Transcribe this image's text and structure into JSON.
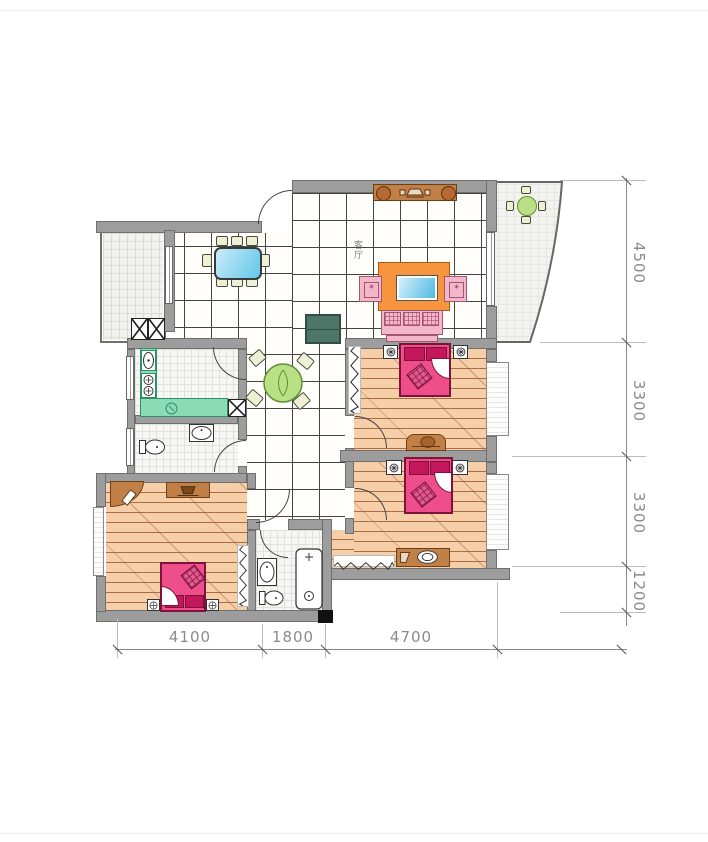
{
  "drawing": {
    "type": "apartment-floor-plan",
    "labels": {
      "living_room": "客厅"
    },
    "dims": {
      "right": [
        {
          "label": "4500"
        },
        {
          "label": "3300"
        },
        {
          "label": "3300"
        },
        {
          "label": "1200"
        }
      ],
      "bottom": [
        {
          "label": "4100"
        },
        {
          "label": "1800"
        },
        {
          "label": "4700"
        }
      ]
    },
    "colors": {
      "wall": "#9d9d9d",
      "wall_outline": "#6f6f6f",
      "wood_floor": "#f6cfa9",
      "wood_line": "#a96c43",
      "bed": "#ee4f8b",
      "bed_dark": "#c2175b",
      "sofa_pink": "#f3b7c9",
      "tv_cabinet_orange": "#f6953d",
      "tv_screen_blue": "#57bfe6",
      "kitchen_counter_green": "#8adcb6",
      "hall_table_green": "#b9e085",
      "cabinet_darkgreen": "#4d7668",
      "furniture_brown": "#c28049",
      "dining_table_blue": "#8ed4ea",
      "dimension_text": "#8b8b8b"
    },
    "furniture": [
      "dining-table",
      "tv-cabinet",
      "sofa",
      "armchairs",
      "entry-console",
      "round-table",
      "balcony-table",
      "kitchen-counter",
      "sink",
      "stove",
      "fridge",
      "toilet",
      "bathtub",
      "double-bed",
      "nightstand",
      "dresser",
      "vanity",
      "radiator",
      "ac-unit",
      "corner-shelf"
    ]
  }
}
